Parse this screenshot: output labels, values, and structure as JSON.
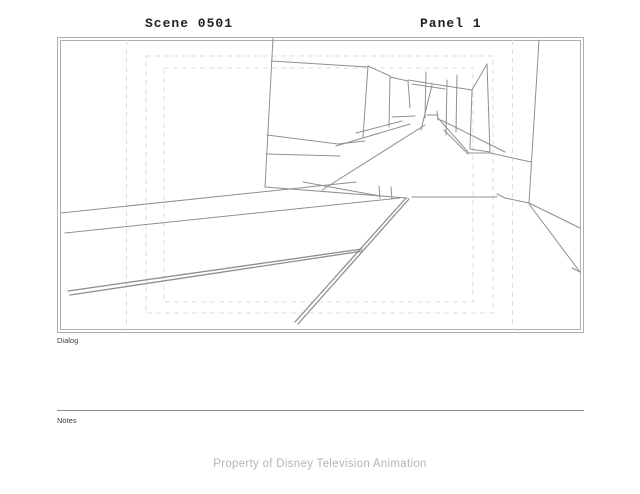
{
  "header": {
    "scene_label": "Scene 0501",
    "panel_label": "Panel 1"
  },
  "board": {
    "dialog_label": "Dialog",
    "notes_label": "Notes"
  },
  "footer": {
    "text": "Property of Disney Television Animation"
  },
  "colors": {
    "frame": "#aeaeae",
    "guides": "#dcdcdc",
    "sketch": "#8f8f8f",
    "header_text": "#1f1f1f",
    "label_text": "#3c3c3c",
    "footer_text": "#b5b5b5"
  },
  "sketch": {
    "frame_rects": [
      [
        57.5,
        37.5,
        583.5,
        332.5
      ],
      [
        60.5,
        40.5,
        580.5,
        329.5
      ]
    ],
    "guide_verticals": [
      [
        126.5,
        40,
        330
      ],
      [
        512.5,
        40,
        330
      ]
    ],
    "safe_rects": [
      [
        146,
        56,
        493,
        313
      ],
      [
        164,
        68,
        473,
        302
      ]
    ],
    "segments": [
      [
        273,
        38,
        265,
        187
      ],
      [
        271,
        61,
        368,
        67
      ],
      [
        368,
        66,
        390,
        76
      ],
      [
        368,
        66,
        363,
        137
      ],
      [
        267,
        135,
        338,
        144
      ],
      [
        338,
        144,
        365,
        141
      ],
      [
        266,
        154,
        340,
        156
      ],
      [
        390,
        77,
        389,
        127
      ],
      [
        390,
        77,
        408,
        81
      ],
      [
        408,
        81,
        410,
        108
      ],
      [
        392,
        117,
        415,
        116
      ],
      [
        426,
        72,
        425,
        118
      ],
      [
        447,
        80,
        446,
        135
      ],
      [
        457,
        75,
        456,
        132
      ],
      [
        408,
        80,
        472,
        90
      ],
      [
        412,
        84,
        445,
        89
      ],
      [
        432,
        85,
        421,
        130
      ],
      [
        427,
        115,
        438,
        115
      ],
      [
        437,
        111,
        438,
        120
      ],
      [
        487,
        64,
        472,
        90
      ],
      [
        472,
        90,
        470,
        148
      ],
      [
        487,
        64,
        490,
        153
      ],
      [
        470,
        149,
        490,
        152
      ],
      [
        425,
        125,
        322,
        190
      ],
      [
        336,
        146,
        410,
        124
      ],
      [
        356,
        133,
        402,
        121
      ],
      [
        441,
        120,
        505,
        152
      ],
      [
        438,
        118,
        468,
        152
      ],
      [
        444,
        130,
        468,
        154
      ],
      [
        468,
        153,
        490,
        153
      ],
      [
        490,
        153,
        531,
        162
      ],
      [
        61,
        213,
        356,
        182
      ],
      [
        65,
        233,
        400,
        198
      ],
      [
        265,
        187,
        407,
        198
      ],
      [
        303,
        182,
        380,
        196
      ],
      [
        68,
        291,
        362,
        249,
        1.3
      ],
      [
        70,
        295,
        363,
        251,
        1.3
      ],
      [
        406,
        198,
        295,
        322,
        1.3
      ],
      [
        409,
        199,
        298,
        324,
        1.3
      ],
      [
        379,
        186,
        380,
        198
      ],
      [
        391,
        187,
        392,
        199
      ],
      [
        412,
        197,
        497,
        197
      ],
      [
        497,
        194,
        505,
        198
      ],
      [
        505,
        198,
        529,
        203
      ],
      [
        539,
        40,
        529,
        203
      ],
      [
        529,
        203,
        580,
        228
      ],
      [
        529,
        204,
        580,
        272
      ],
      [
        580,
        272,
        572,
        268
      ]
    ]
  }
}
